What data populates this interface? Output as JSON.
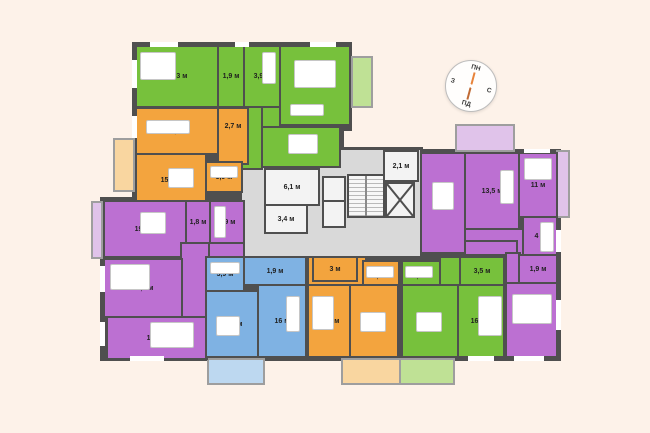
{
  "compass": {
    "north": "ПН",
    "east": "С",
    "south": "ПД",
    "west": "З"
  },
  "colors": {
    "green": "#77c13c",
    "orange": "#f3a43e",
    "purple": "#bc70d2",
    "blue": "#7fb2e3",
    "walls": "#4f4f4f",
    "corridor": "#d9d9d9",
    "background": "#fdf2e9",
    "needle": "#e8833a"
  },
  "units_suffix": "м",
  "apartments": [
    {
      "name": "apartment-green-top-left",
      "color": "green",
      "rooms": [
        {
          "name": "bedroom",
          "area": "16,3 м"
        },
        {
          "name": "wc",
          "area": "1,9 м"
        },
        {
          "name": "bathroom",
          "area": "3,9 м"
        },
        {
          "name": "living-room",
          "area": "22,5 м"
        },
        {
          "name": "kitchen",
          "area": "16,3 м"
        }
      ]
    },
    {
      "name": "apartment-orange-left",
      "color": "orange",
      "rooms": [
        {
          "name": "living-room",
          "area": "16,7 м"
        },
        {
          "name": "hallway",
          "area": "2,7 м"
        },
        {
          "name": "kitchen",
          "area": "15,2 м"
        },
        {
          "name": "bathroom",
          "area": "3,9 м"
        }
      ]
    },
    {
      "name": "apartment-purple-left",
      "color": "purple",
      "rooms": [
        {
          "name": "kitchen",
          "area": "19,4 м"
        },
        {
          "name": "wc",
          "area": "1,8 м"
        },
        {
          "name": "bathroom",
          "area": "3,9 м"
        },
        {
          "name": "bedroom",
          "area": "17,1 м"
        },
        {
          "name": "bedroom",
          "area": "17,4 м"
        }
      ]
    },
    {
      "name": "apartment-blue-bottom",
      "color": "blue",
      "rooms": [
        {
          "name": "bathroom",
          "area": "3,9 м"
        },
        {
          "name": "hallway",
          "area": "1,9 м"
        },
        {
          "name": "kitchen",
          "area": "17,4 м"
        },
        {
          "name": "living-room",
          "area": "16 м"
        }
      ]
    },
    {
      "name": "apartment-orange-bottom",
      "color": "orange",
      "rooms": [
        {
          "name": "wc",
          "area": "3 м"
        },
        {
          "name": "bathroom",
          "area": "3,9 м"
        },
        {
          "name": "kitchen",
          "area": "15,3 м"
        },
        {
          "name": "living-room",
          "area": "17,2 м"
        }
      ]
    },
    {
      "name": "apartment-green-bottom",
      "color": "green",
      "rooms": [
        {
          "name": "bathroom",
          "area": "3,9 м"
        },
        {
          "name": "wardrobe",
          "area": "3,5 м"
        },
        {
          "name": "kitchen",
          "area": "17,7 м"
        },
        {
          "name": "bedroom",
          "area": "16,8 м"
        }
      ]
    },
    {
      "name": "apartment-purple-right",
      "color": "purple",
      "rooms": [
        {
          "name": "kitchen-living",
          "area": "22,6 м"
        },
        {
          "name": "room",
          "area": "13,5 м"
        },
        {
          "name": "bedroom",
          "area": "11 м"
        },
        {
          "name": "bathroom",
          "area": "4 м"
        },
        {
          "name": "wc",
          "area": "1,9 м"
        },
        {
          "name": "bedroom",
          "area": "18,7 м"
        }
      ]
    }
  ],
  "core": {
    "rooms": [
      {
        "name": "hall",
        "area": "6,1 м"
      },
      {
        "name": "hall",
        "area": "3,4 м"
      },
      {
        "name": "vestibule",
        "area": "2,1 м"
      }
    ]
  }
}
